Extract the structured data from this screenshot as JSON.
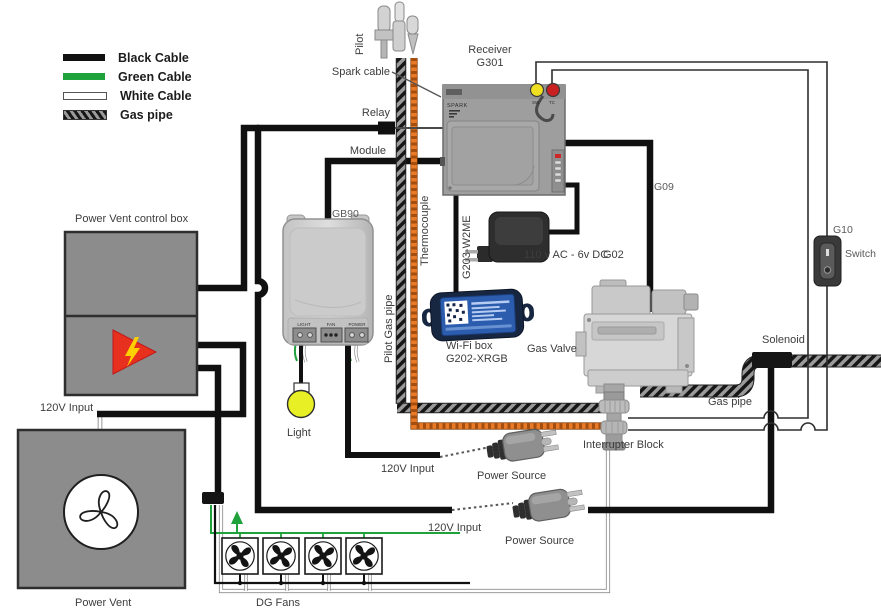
{
  "legend": {
    "items": [
      {
        "label": "Black Cable",
        "type": "black"
      },
      {
        "label": "Green Cable",
        "type": "green"
      },
      {
        "label": "White Cable",
        "type": "white"
      },
      {
        "label": "Gas pipe",
        "type": "gas"
      }
    ]
  },
  "components": {
    "pilot": "Pilot",
    "spark_cable": "Spark cable",
    "receiver": {
      "name": "Receiver",
      "model": "G301",
      "spark": "SPARK",
      "sw": "SW",
      "tc": "TC"
    },
    "relay": "Relay",
    "module": "Module",
    "gb90": {
      "model": "GB90",
      "terminals": [
        "LIGHT",
        "FAN",
        "POWER"
      ]
    },
    "thermocouple": "Thermocouple",
    "pilot_gas_pipe": "Pilot Gas pipe",
    "g203": "G203-W2ME",
    "adapter": {
      "label": "110 v AC - 6v DC",
      "model": "G02"
    },
    "wifi": {
      "name": "Wi-Fi box",
      "model": "G202-XRGB"
    },
    "gas_valve": "Gas Valve",
    "g09": "G09",
    "g10": "G10",
    "switch": "Switch",
    "solenoid": "Solenoid",
    "gas_pipe": "Gas pipe",
    "interrupter": "Interrupter Block",
    "power_vent_control_box": "Power Vent control box",
    "power_vent": "Power Vent",
    "light": "Light",
    "dg_fans": "DG Fans",
    "inputs": {
      "v120_a": "120V Input",
      "v120_b": "120V Input",
      "v120_c": "120V Input"
    },
    "power_source_a": "Power Source",
    "power_source_b": "Power Source"
  },
  "colors": {
    "cable_black": "#111111",
    "cable_green": "#1fa23c",
    "cable_white": "#ffffff",
    "thermocouple_orange": "#e87a28",
    "receiver_sw_yellow": "#f0df20",
    "receiver_tc_red": "#c92121",
    "light_yellow": "#e9ef25",
    "warning_red": "#e8301e",
    "bolt_yellow": "#ffd000",
    "wifi_blue": "#2b5cad",
    "box_gray": "#8c8c8c"
  }
}
